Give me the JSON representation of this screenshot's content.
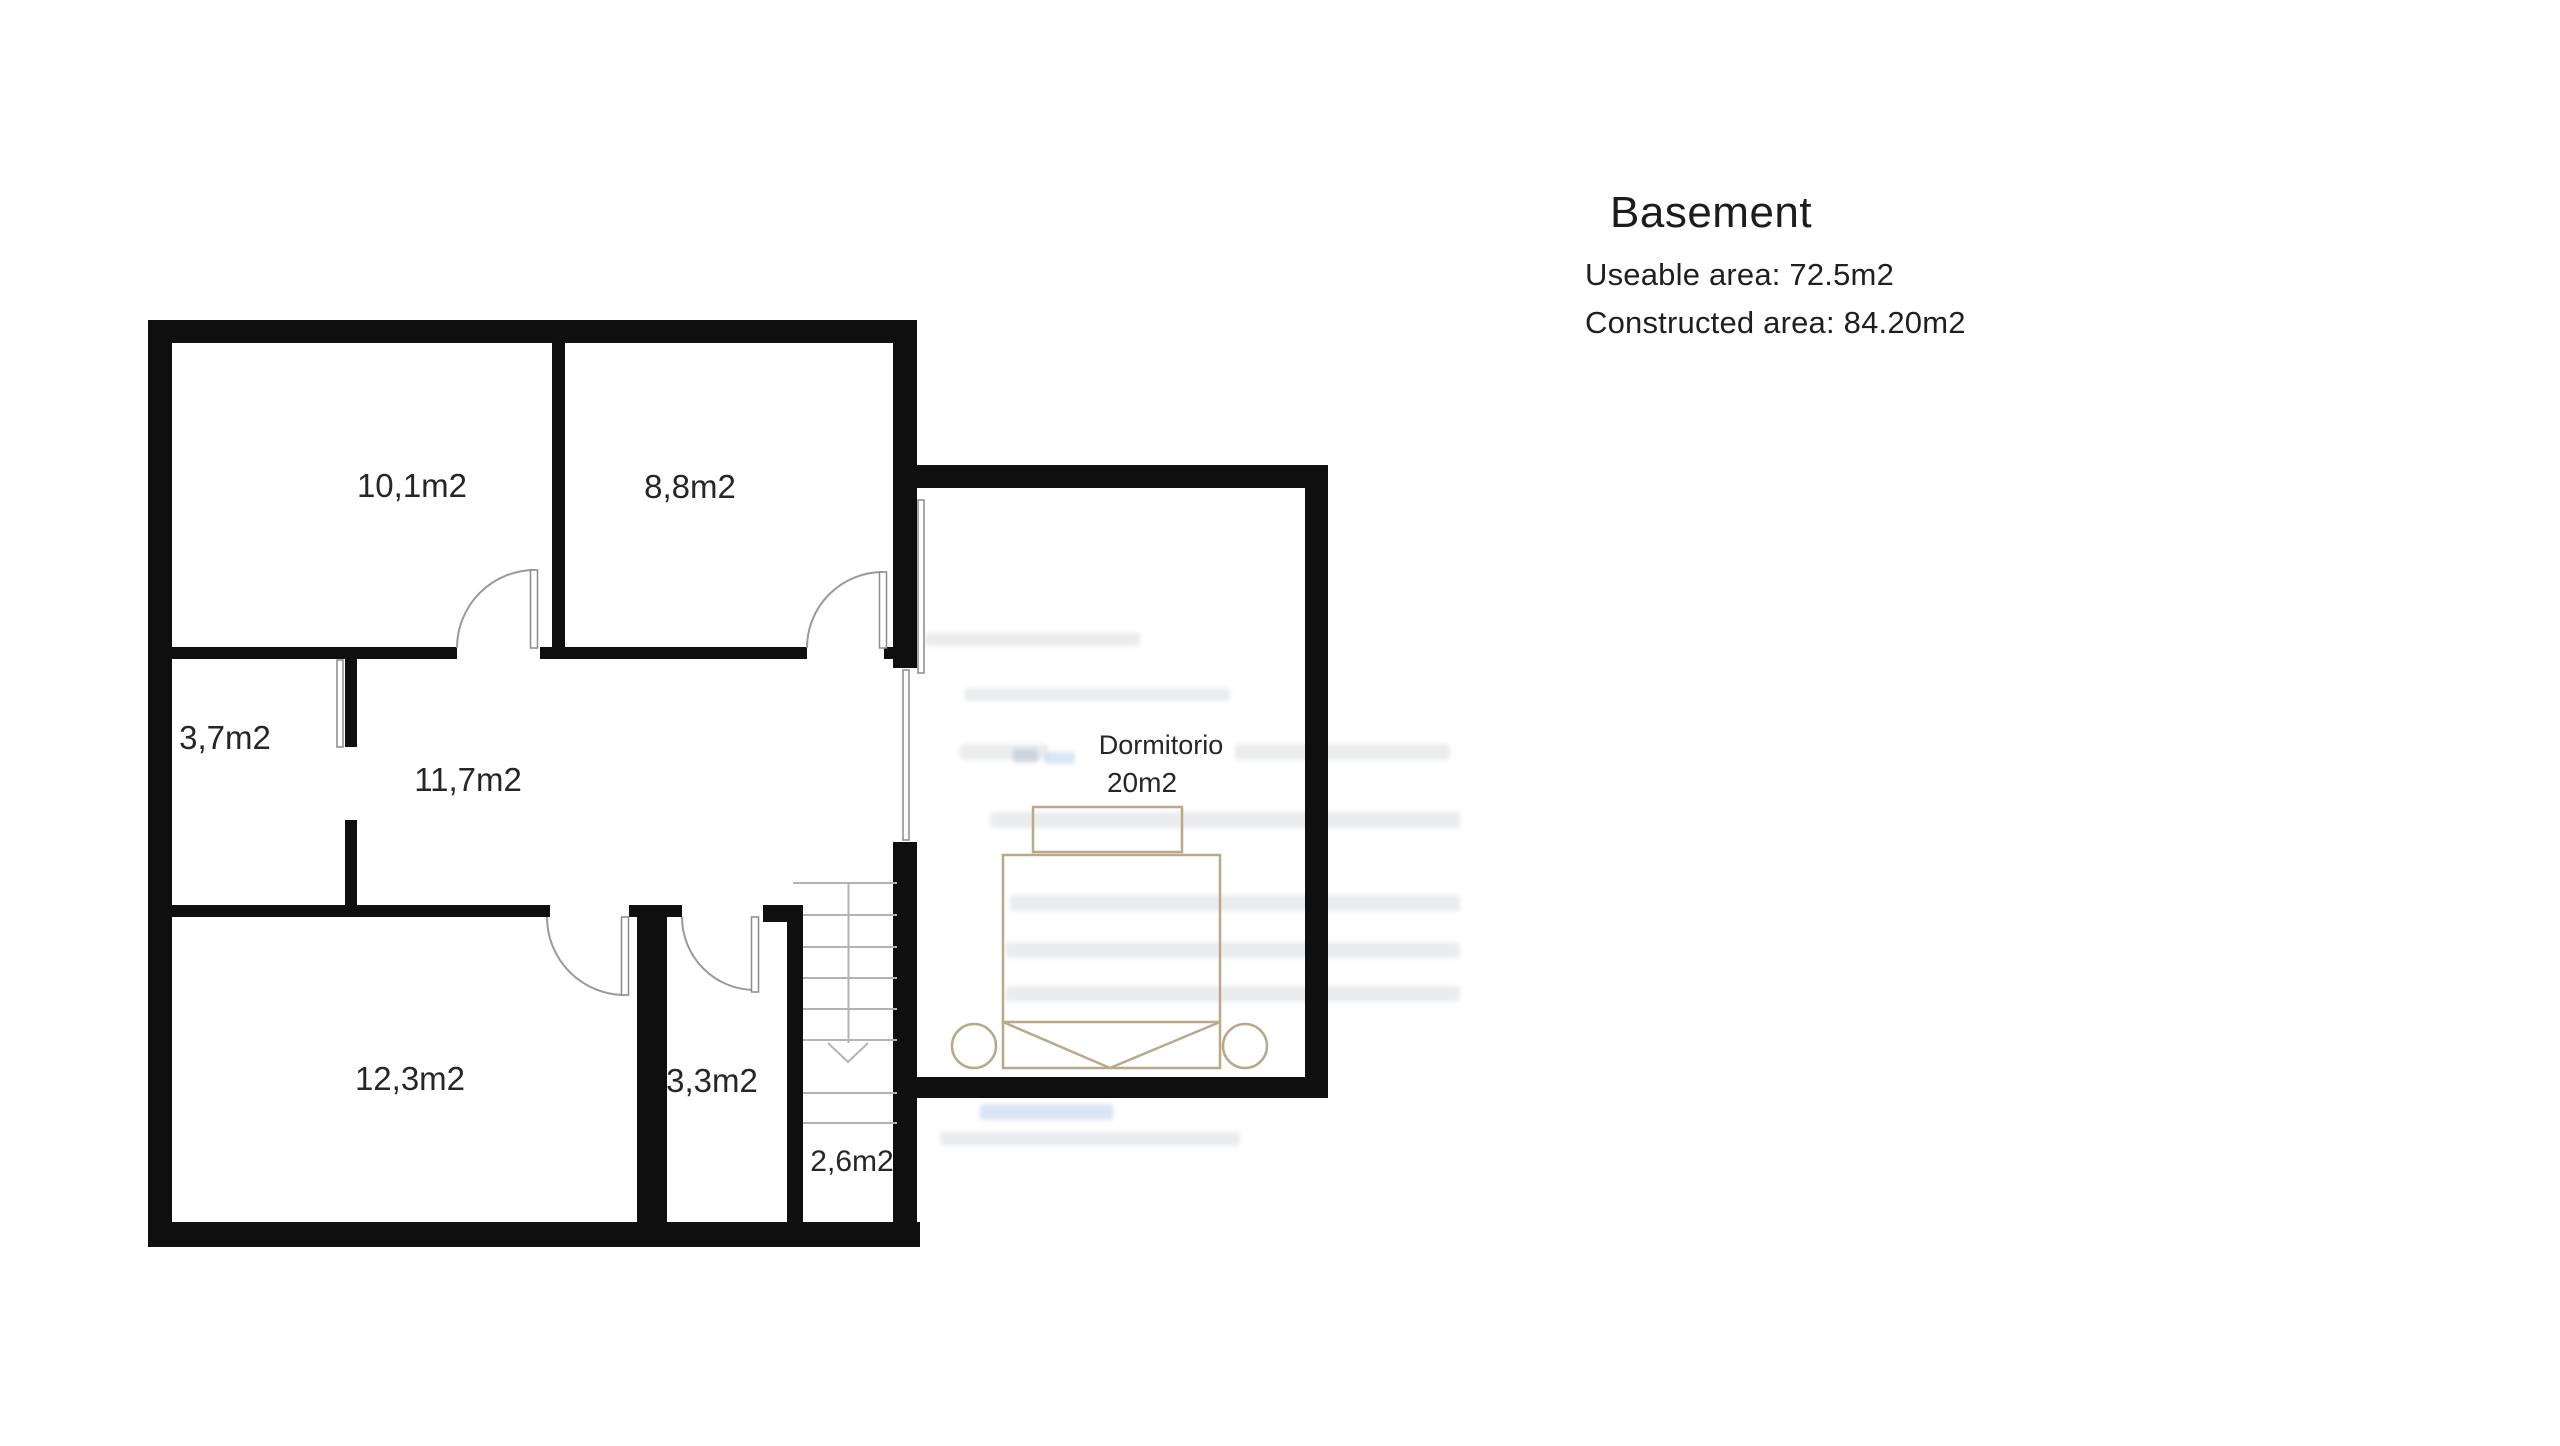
{
  "panel": {
    "title": "Basement",
    "useable_area": "Useable area: 72.5m2",
    "constructed_area": "Constructed area: 84.20m2"
  },
  "floorplan": {
    "rooms": [
      {
        "label": "10,1m2"
      },
      {
        "label": "8,8m2"
      },
      {
        "label": "3,7m2"
      },
      {
        "label": "11,7m2"
      },
      {
        "label": "12,3m2"
      },
      {
        "label": "3,3m2"
      },
      {
        "label": "2,6m2"
      }
    ],
    "bedroom": {
      "name": "Dormitorio",
      "area": "20m2"
    },
    "stairs": {
      "direction": "down-arrow"
    },
    "colors": {
      "wall": "#0f0f0f",
      "bed_outline": "#b9a98c",
      "stair_line": "#b3b3b3",
      "door_line": "#9a9a9a",
      "label_text": "#262626",
      "panel_text": "#1c1c1c"
    }
  }
}
